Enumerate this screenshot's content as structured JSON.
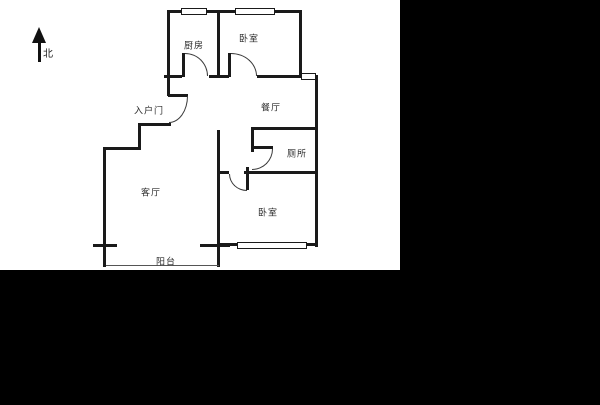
{
  "plan": {
    "north_label": "北",
    "rooms": [
      {
        "id": "kitchen",
        "label": "厨房"
      },
      {
        "id": "bedroom-north",
        "label": "卧室"
      },
      {
        "id": "dining",
        "label": "餐厅"
      },
      {
        "id": "entry-door",
        "label": "入户门"
      },
      {
        "id": "toilet",
        "label": "厕所"
      },
      {
        "id": "living",
        "label": "客厅"
      },
      {
        "id": "bedroom-south",
        "label": "卧室"
      },
      {
        "id": "balcony",
        "label": "阳台"
      }
    ],
    "colors": {
      "wall": "#1a1a1a",
      "background": "#ffffff",
      "matte": "#000000",
      "label": "#2b2b2b"
    }
  }
}
